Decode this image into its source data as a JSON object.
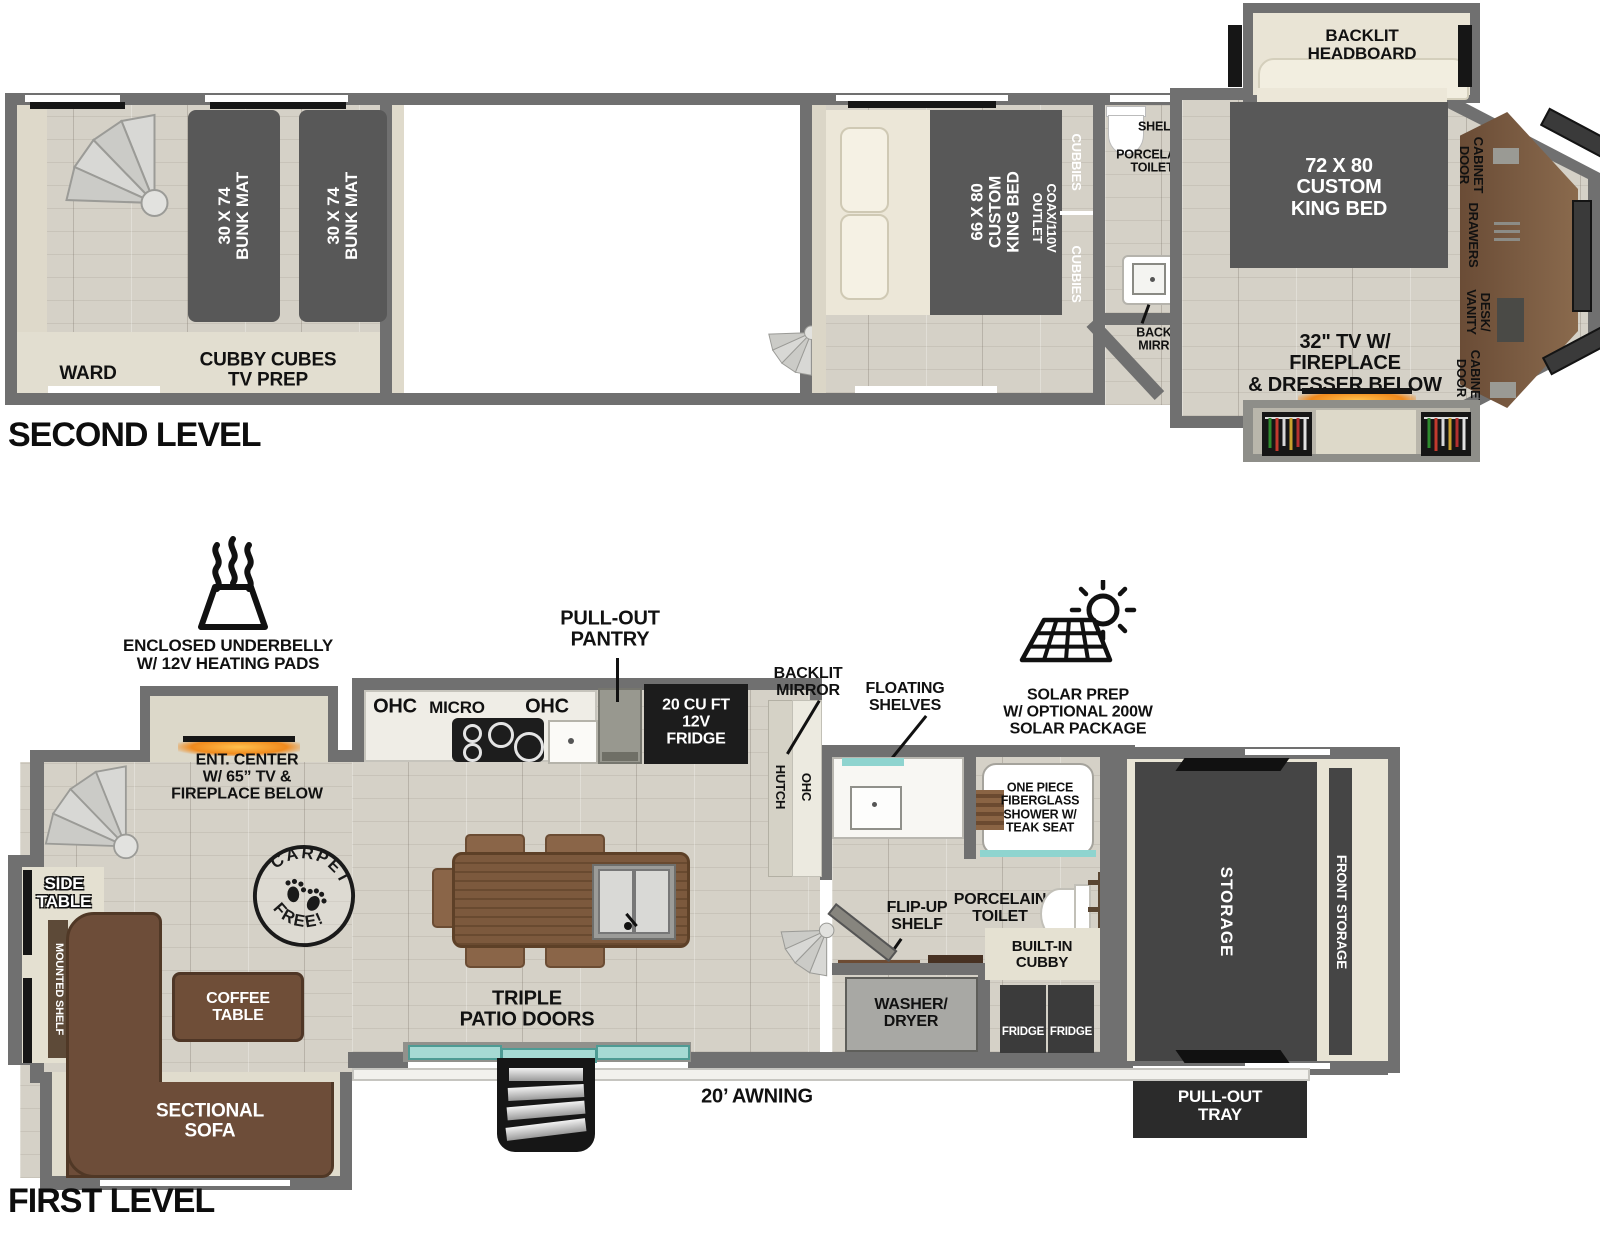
{
  "second_level": {
    "title": "SECOND LEVEL",
    "bunk_mat_1": "30 X 74\nBUNK MAT",
    "bunk_mat_2": "30 X 74\nBUNK MAT",
    "ward": "WARD",
    "cubby_cubes": "CUBBY CUBES\nTV PREP",
    "mid_bed": "66 X 80\nCUSTOM\nKING BED",
    "cubbies_top": "CUBBIES",
    "coax_outlet": "COAX/110V\nOUTLET",
    "cubbies_bottom": "CUBBIES",
    "shelf": "SHELF",
    "toilet": "PORCELAIN\nTOILET",
    "shelves": "SHELVES",
    "backlit_mirror": "BACKLIT\nMIRROR",
    "headboard": "BACKLIT\nHEADBOARD",
    "front_bed": "72 X 80\nCUSTOM\nKING BED",
    "cabinet_door_1": "CABINET\nDOOR",
    "drawers": "DRAWERS",
    "desk_vanity": "DESK/\nVANITY",
    "cabinet_door_2": "CABINET\nDOOR",
    "tv_fireplace": "32\" TV W/\nFIREPLACE\n& DRESSER BELOW"
  },
  "first_level": {
    "title": "FIRST LEVEL",
    "underbelly": "ENCLOSED UNDERBELLY\nW/ 12V HEATING PADS",
    "ent_center": "ENT. CENTER\nW/ 65” TV &\nFIREPLACE BELOW",
    "pull_out_pantry": "PULL-OUT\nPANTRY",
    "ohc_left": "OHC",
    "micro": "MICRO",
    "ohc_right": "OHC",
    "fridge_12v": "20 CU FT\n12V\nFRIDGE",
    "hutch": "HUTCH",
    "ohc_hutch": "OHC",
    "backlit_mirror": "BACKLIT\nMIRROR",
    "floating_shelves": "FLOATING\nSHELVES",
    "solar": "SOLAR PREP\nW/ OPTIONAL 200W\nSOLAR PACKAGE",
    "shower": "ONE PIECE\nFIBERGLASS\nSHOWER W/\nTEAK SEAT",
    "porcelain_toilet": "PORCELAIN\nTOILET",
    "flip_up_shelf": "FLIP-UP\nSHELF",
    "built_in_cubby": "BUILT-IN\nCUBBY",
    "washer_dryer": "WASHER/\nDRYER",
    "fridge_1": "FRIDGE",
    "fridge_2": "FRIDGE",
    "storage": "STORAGE",
    "front_storage": "FRONT STORAGE",
    "pull_out_tray": "PULL-OUT\nTRAY",
    "side_table": "SIDE\nTABLE",
    "mounted_shelf": "MOUNTED SHELF",
    "coffee_table": "COFFEE\nTABLE",
    "sectional_sofa": "SECTIONAL\nSOFA",
    "triple_patio_doors": "TRIPLE\nPATIO DOORS",
    "awning": "20’ AWNING",
    "carpet_stamp_top": "CARPET",
    "carpet_stamp_bottom": "FREE!"
  }
}
